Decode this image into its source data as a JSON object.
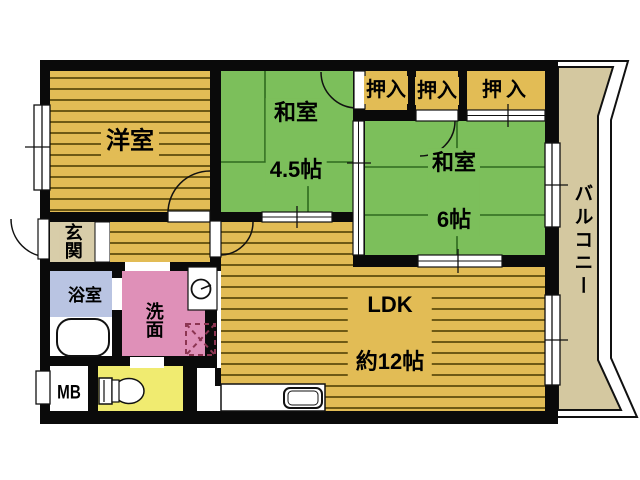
{
  "title": "apartment-floor-plan",
  "rooms": {
    "western": {
      "label": "洋室"
    },
    "jp45": {
      "line1": "和室",
      "line2": "4.5帖"
    },
    "jp6": {
      "line1": "和室",
      "line2": "6帖"
    },
    "ldk": {
      "line1": "LDK",
      "line2": "約12帖"
    },
    "closet1": {
      "label": "押入"
    },
    "closet2": {
      "label": "押入"
    },
    "closet3": {
      "label": "押入"
    },
    "balcony": {
      "label": "バルコニー"
    },
    "entrance": {
      "label": "玄関"
    },
    "bath": {
      "label": "浴室"
    },
    "wash": {
      "label": "洗面"
    },
    "meter_box": {
      "label": "MB"
    }
  },
  "colors": {
    "wall": "#0a0a0a",
    "wood_floor": "#e2bc55",
    "wood_stripe": "#6e5a15",
    "tatami_green": "#7cbf5b",
    "tatami_line": "#2e6a1f",
    "balcony_beige": "#d4c8a0",
    "entrance_beige": "#d8cda9",
    "bath_blue": "#b9c4e2",
    "wash_pink": "#df90b8",
    "toilet_yellow": "#f0eb70",
    "washer_dash": "#8c3552"
  }
}
